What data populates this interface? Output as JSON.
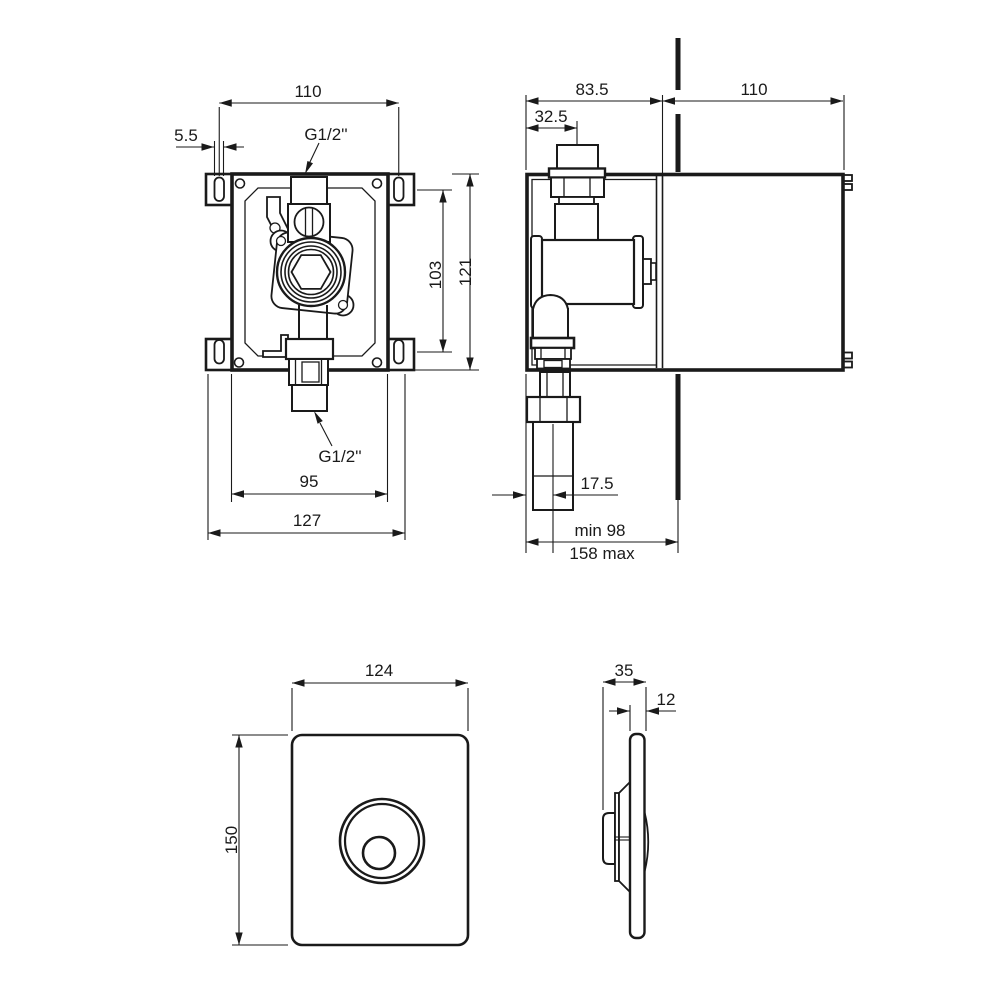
{
  "front_view": {
    "title": "concealed valve box - front view",
    "dim_slot_spacing_h": "110",
    "dim_slot_width": "5.5",
    "label_inlet_thread": "G1/2''",
    "label_outlet_thread": "G1/2''",
    "dim_slot_spacing_v": "103",
    "dim_box_height": "121",
    "dim_box_width": "95",
    "dim_overall_width": "127"
  },
  "side_view": {
    "title": "concealed valve box - side view",
    "dim_depth_front": "83.5",
    "dim_inlet_offset": "32.5",
    "dim_depth_behind_wall": "110",
    "dim_outlet_offset": "17.5",
    "dim_install_depth_min": "min 98",
    "dim_install_depth_max": "158 max"
  },
  "faceplate_front_view": {
    "title": "faceplate - front view",
    "dim_width": "124",
    "dim_height": "150"
  },
  "faceplate_side_view": {
    "title": "faceplate - side view",
    "dim_depth": "35",
    "dim_plate_thickness": "12"
  }
}
